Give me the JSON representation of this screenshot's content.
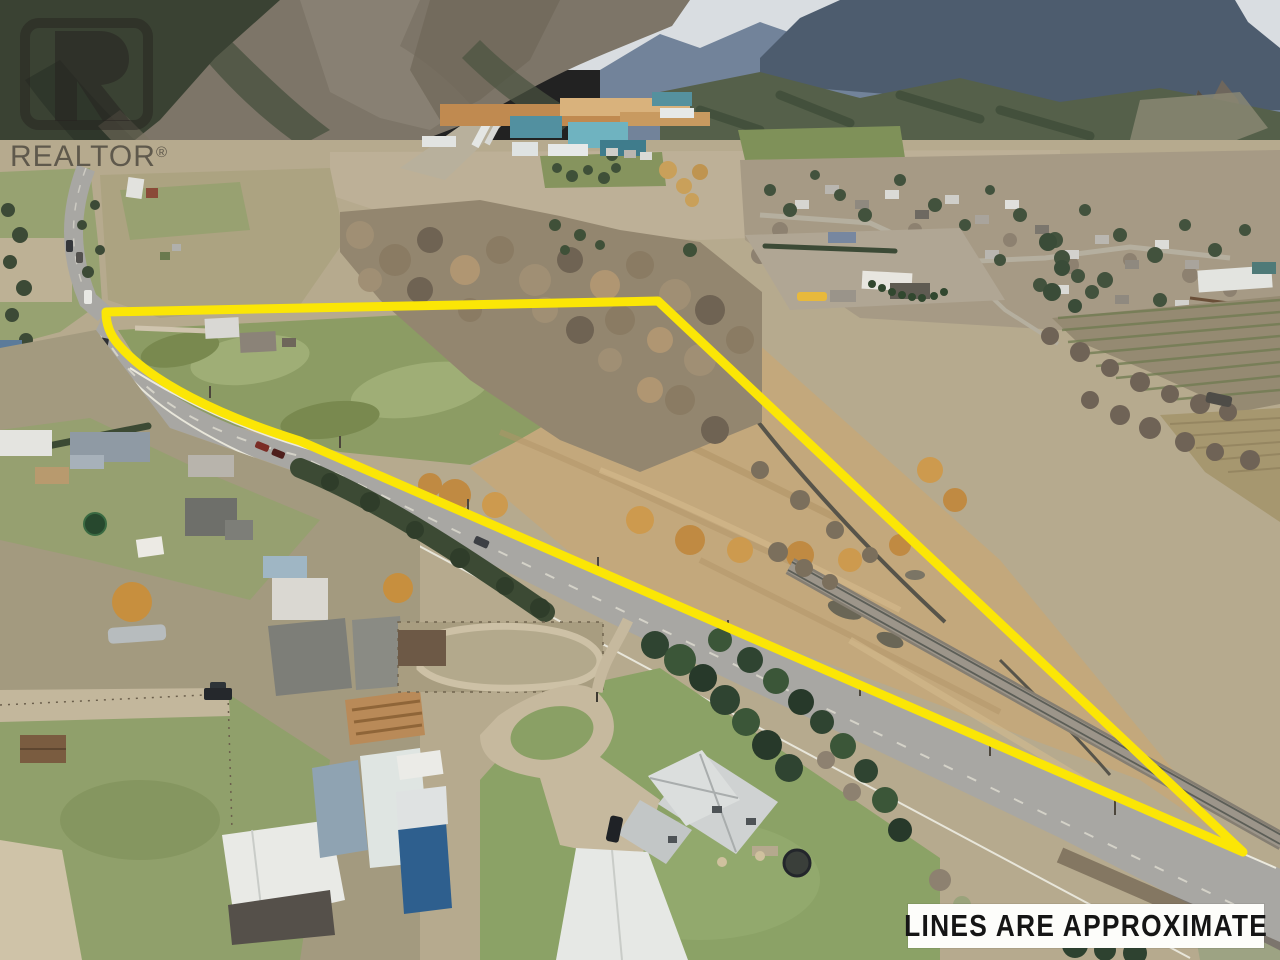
{
  "photo": {
    "description": "Aerial drone photo of a rural valley property listing: highway and railway run diagonally, a triangular parcel is outlined in yellow between farm fields, marsh and a creek, with a sawmill town and mountains beyond.",
    "palette": {
      "sky_haze": "#d9dde1",
      "far_ridge_blue": "#53637a",
      "mountain_rock": "#7d7568",
      "forest_dark_green": "#3c4a36",
      "valley_tan": "#b6aa8e",
      "field_green": "#8c9c64",
      "marsh_gold": "#c3a87c",
      "willow_orange": "#c08a42",
      "road_gray": "#a8a7a3",
      "lawn_green": "#8ba266"
    }
  },
  "boundary": {
    "label": "property-boundary-line",
    "color": "#fbe606",
    "stroke_width": 9,
    "path_d": "M106,312 L658,301 L1243,852 L300,441 C220,416 150,382 118,344 Q106,330 106,312 Z"
  },
  "watermark": {
    "brand": "REALTOR",
    "registered_mark": "®",
    "color": "rgba(42,39,35,0.6)"
  },
  "overlay": {
    "disclaimer": "LINES ARE APPROXIMATE",
    "disclaimer_bg": "#ffffff",
    "disclaimer_text_color": "#151515"
  }
}
